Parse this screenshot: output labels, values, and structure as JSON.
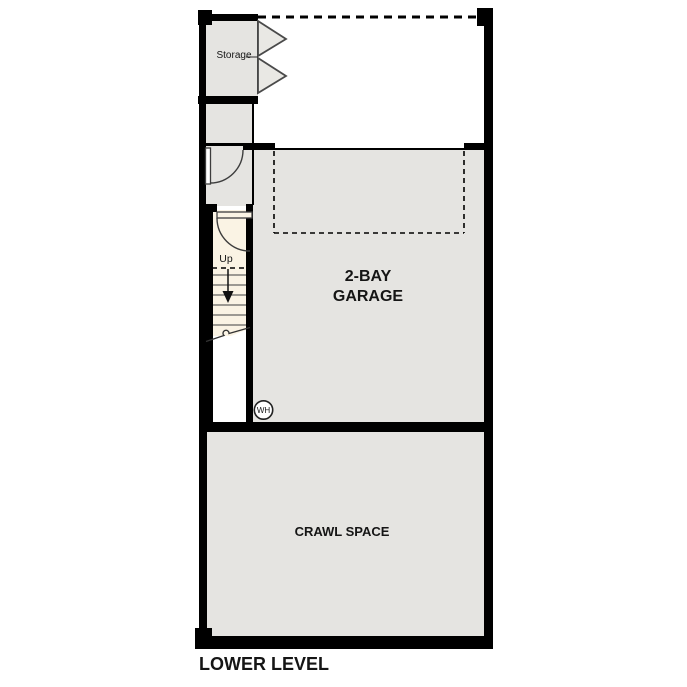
{
  "plan": {
    "title": "LOWER LEVEL",
    "colors": {
      "wall": "#000000",
      "room": "#e5e4e1",
      "stairs": "#faf3e4",
      "paper": "#ffffff",
      "ink": "#151515"
    },
    "rooms": {
      "storage": {
        "label": "Storage"
      },
      "garage": {
        "label_line1": "2-BAY",
        "label_line2": "GARAGE"
      },
      "crawl_space": {
        "label": "CRAWL SPACE"
      }
    },
    "stairs": {
      "direction_label": "Up"
    },
    "fixtures": {
      "water_heater_label": "WH"
    }
  }
}
